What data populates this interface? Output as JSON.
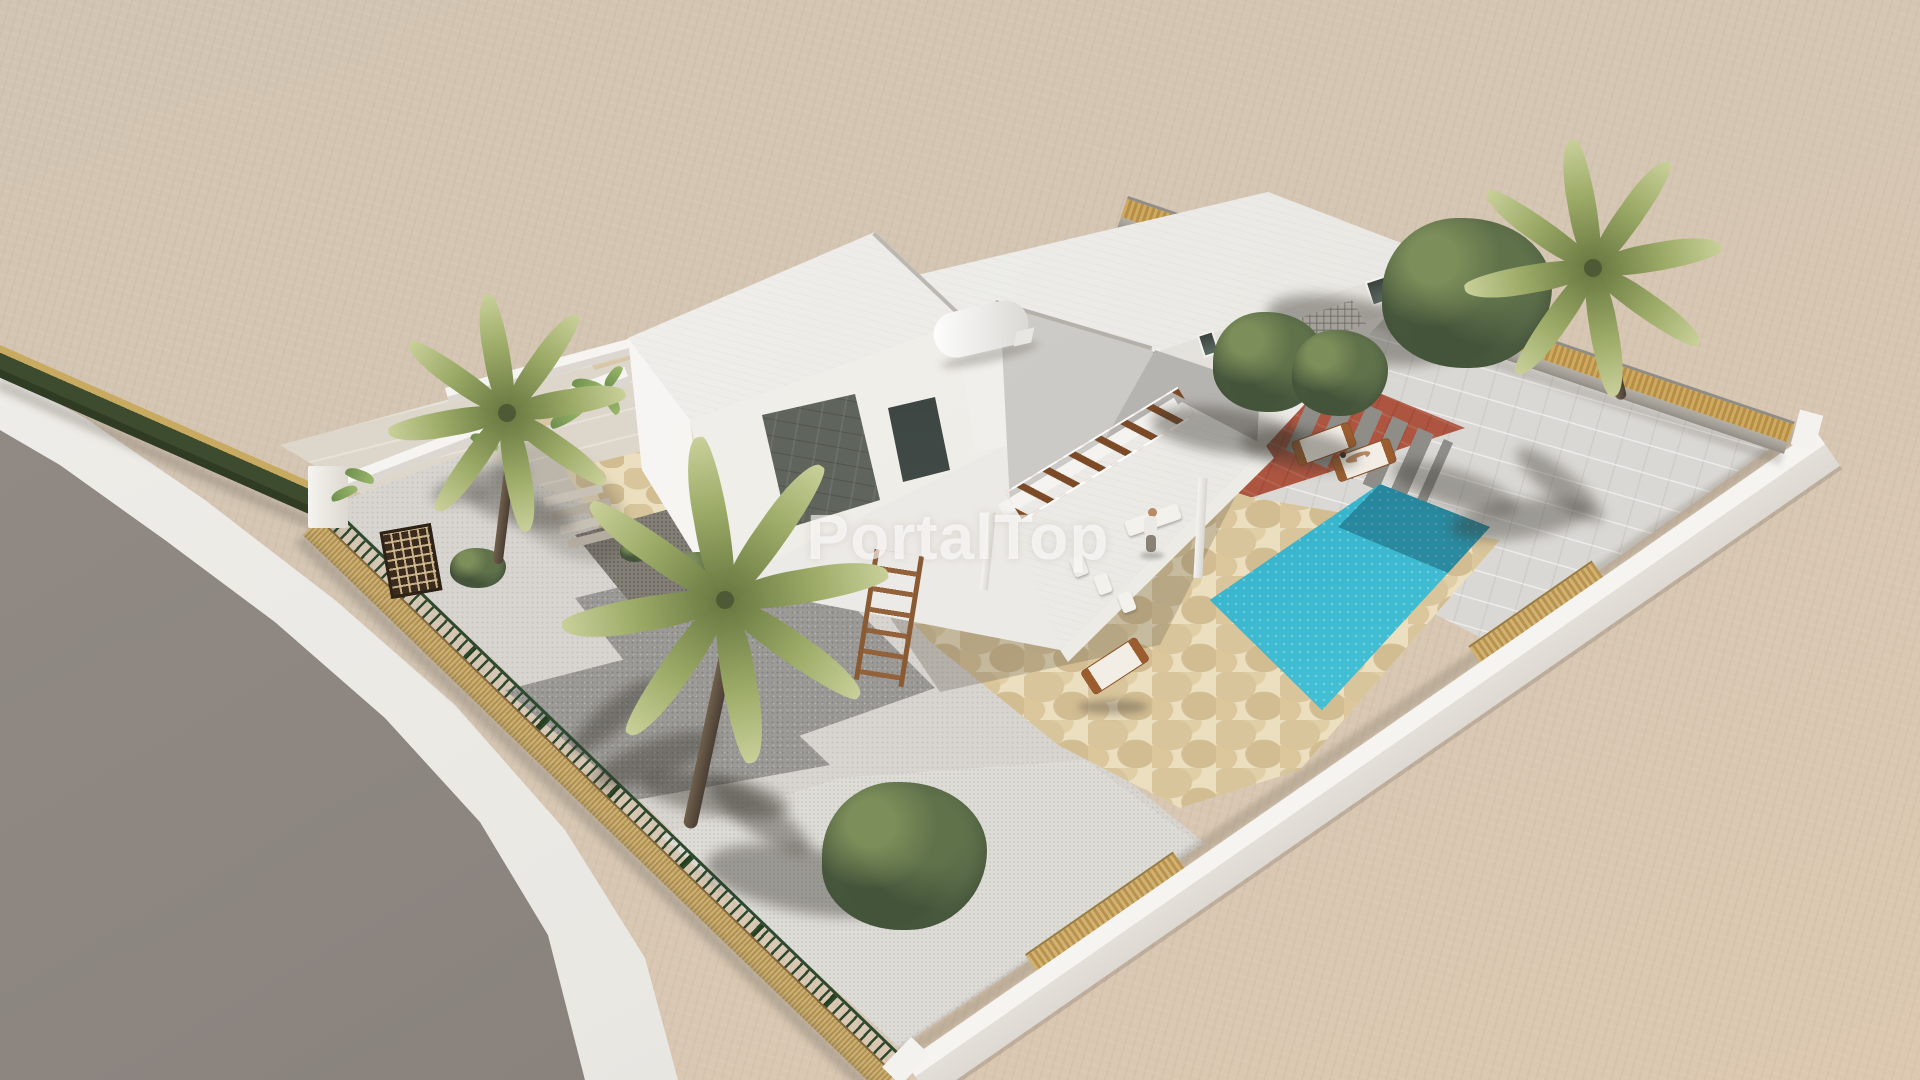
{
  "watermark": {
    "text": "PortalTop"
  },
  "colors": {
    "ground": "#d2c4b2",
    "ground_deep": "#dcc8b0",
    "road": "#8c8580",
    "sidewalk": "#eae8e3",
    "hedge_gold": "#c8aa60",
    "hedge_green": "#3d4c2e",
    "fence_green": "#2d4a2e",
    "cane": "#c3a566",
    "wall_white": "#f5f4f1",
    "wall_shade": "#ded9d2",
    "roof_light": "#f3f2ef",
    "roof_mid": "#e2e0da",
    "patio": "#dad8d4",
    "walkway": "#ddd6ca",
    "driveway": "#d8d5d0",
    "pad": "#9c9a96",
    "gravel": "#dedcd7",
    "flag_base": "#d8c59b",
    "flag_joint": "#ecdfbf",
    "terrace_red": "#ad5540",
    "pool_deep": "#156f90",
    "pool_light": "#55cfdf",
    "beam": "#7c4a27",
    "wood": "#9b5d2e",
    "trunk_light": "#70604d",
    "trunk_dark": "#4a3e33",
    "palm_light": "#9cab67",
    "palm_dark": "#66763f",
    "tree_light": "#7c8e59",
    "tree_dark": "#3c4c32",
    "stone_panel": "#5f645c",
    "person_skin": "#b98a66",
    "watermark": "rgba(255,255,255,0.62)"
  }
}
